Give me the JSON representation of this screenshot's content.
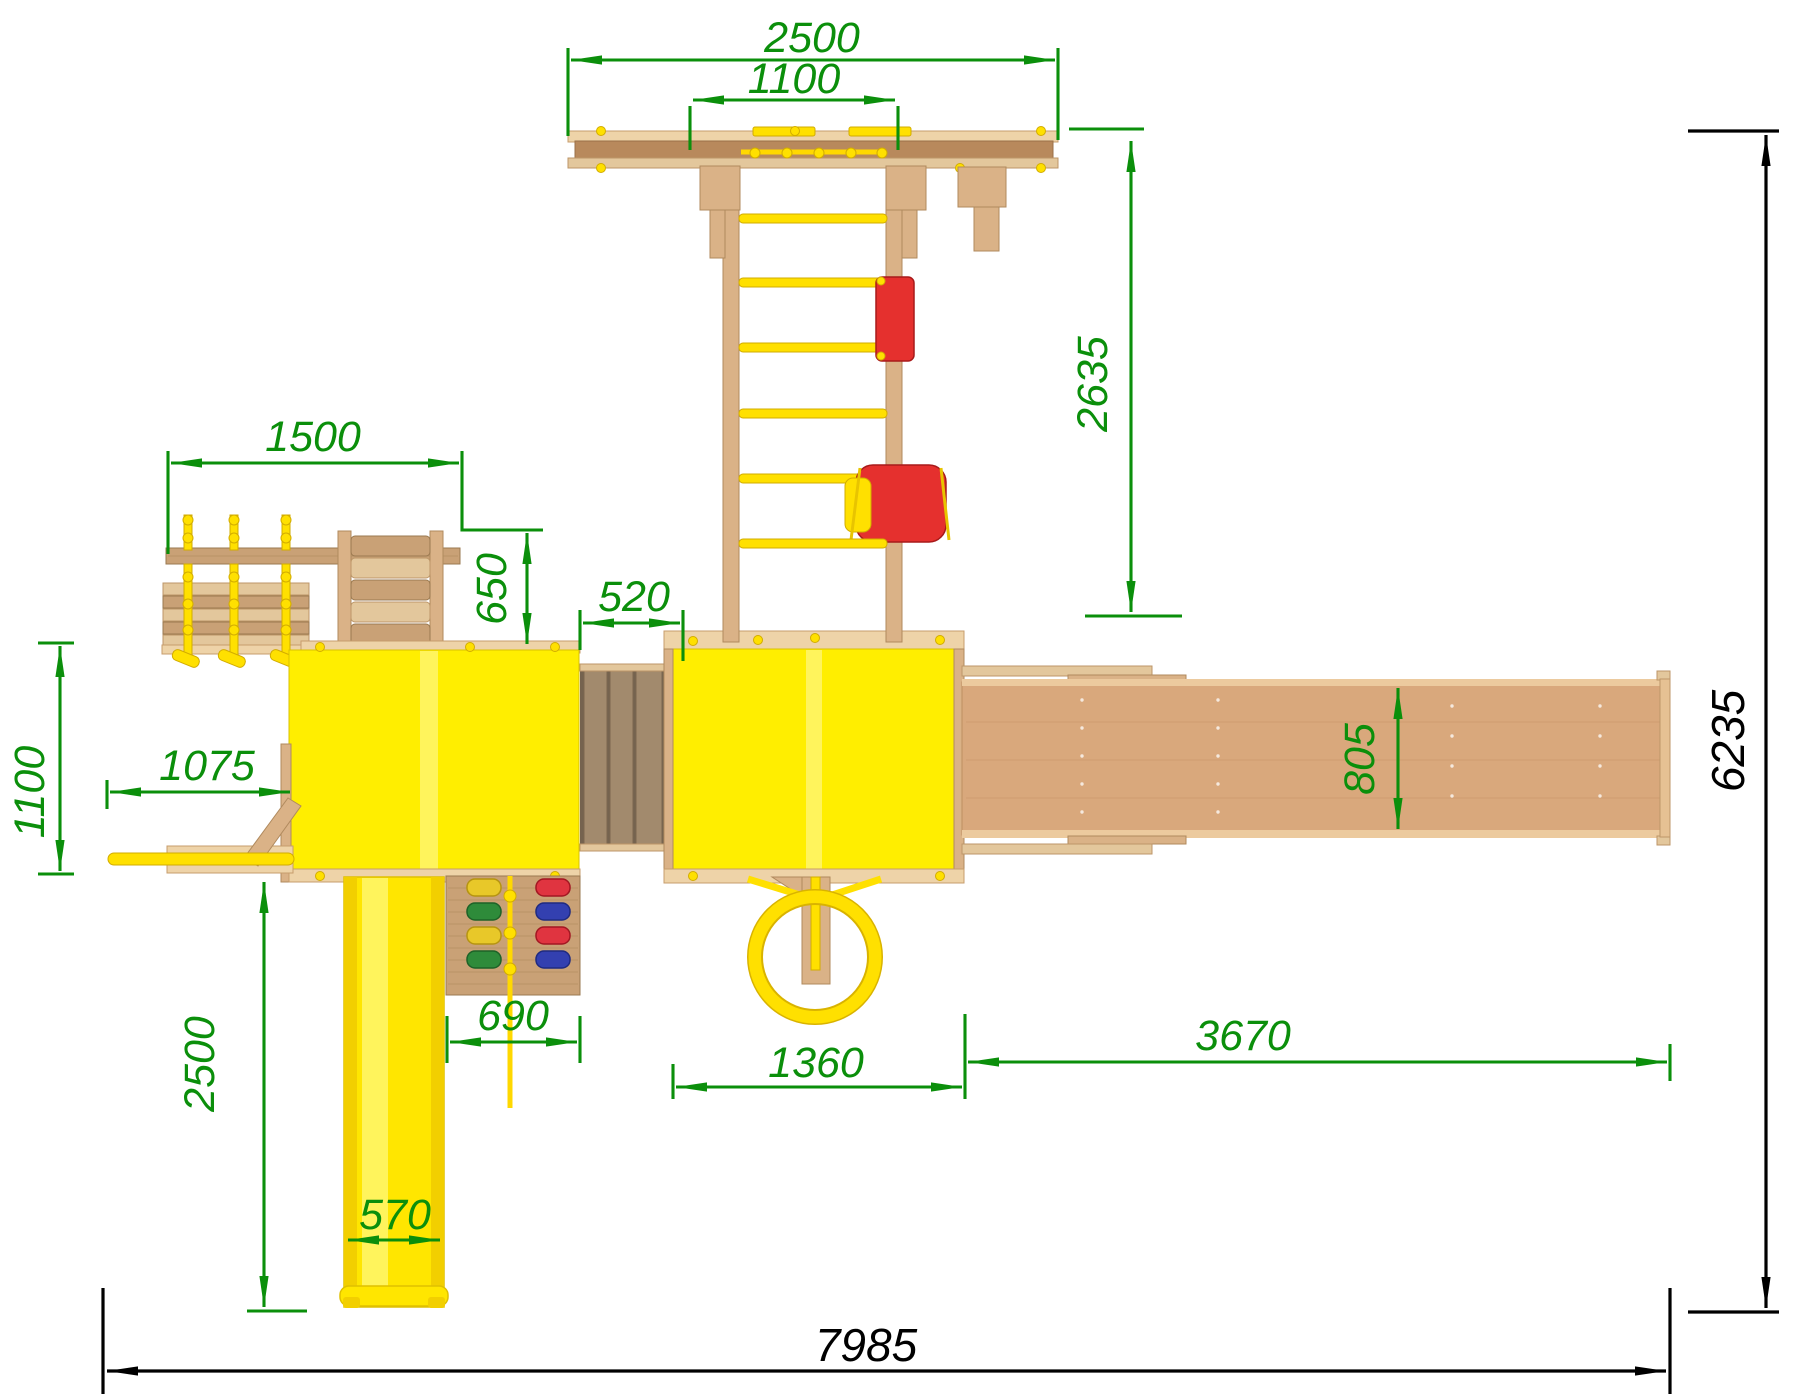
{
  "drawing": {
    "kind": "playground-set-top-view-plan",
    "colors": {
      "background": "#ffffff",
      "dimension_green": "#0b8f0b",
      "dimension_black": "#000000",
      "platform_yellow": "#ffee00",
      "slide_yellow": "#ffe600",
      "rung_yellow": "#ffe000",
      "wood_light": "#eed3a8",
      "wood_medium": "#dab287",
      "wood_dark": "#b8895c",
      "beam_wood": "#d9a87c",
      "accent_red": "#e5302e",
      "hold_green": "#2e8b3a",
      "hold_blue": "#3340b0"
    },
    "dimensions": {
      "top_beam_length": "2500",
      "monkey_bars_width": "1100",
      "monkey_bars_length": "2635",
      "swing_frame_length": "1500",
      "swing_frame_offset": "650",
      "bridge_length": "520",
      "swing_bench_depth": "1100",
      "balance_beam_length": "1075",
      "slide_length": "2500",
      "slide_width": "570",
      "climbing_wall_width": "690",
      "rings_bay_width": "1360",
      "swing_beam_length": "3670",
      "swing_beam_width": "805",
      "overall_depth": "6235",
      "overall_length": "7985"
    }
  }
}
